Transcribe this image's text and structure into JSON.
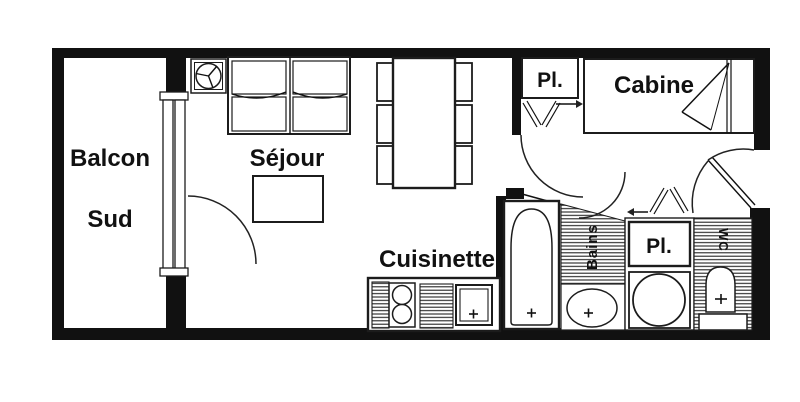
{
  "plan_title": "Apartment floor plan",
  "colors": {
    "background": "#ffffff",
    "line": "#111111"
  },
  "rooms": {
    "balcony": {
      "line1": "Balcon",
      "line2": "Sud"
    },
    "living": {
      "label": "Séjour"
    },
    "kitchen": {
      "label": "Cuisinette"
    },
    "cabin": {
      "label": "Cabine"
    },
    "closet_top": {
      "label": "Pl."
    },
    "closet_bottom": {
      "label": "Pl."
    },
    "bathroom": {
      "label": "Bains"
    },
    "wc": {
      "label": "WC"
    }
  },
  "icons": [
    "window-icon",
    "door-arc-icon",
    "bifold-door-icon",
    "arrow-right-icon",
    "arrow-left-icon",
    "round-table-icon",
    "sofa-bed-icon",
    "coffee-table-icon",
    "dining-table-icon",
    "chair-icon",
    "stove-icon",
    "kitchen-sink-icon",
    "faucet-cross-icon",
    "bathtub-icon",
    "washbasin-icon",
    "water-heater-icon",
    "toilet-icon",
    "cabin-bed-icon"
  ]
}
